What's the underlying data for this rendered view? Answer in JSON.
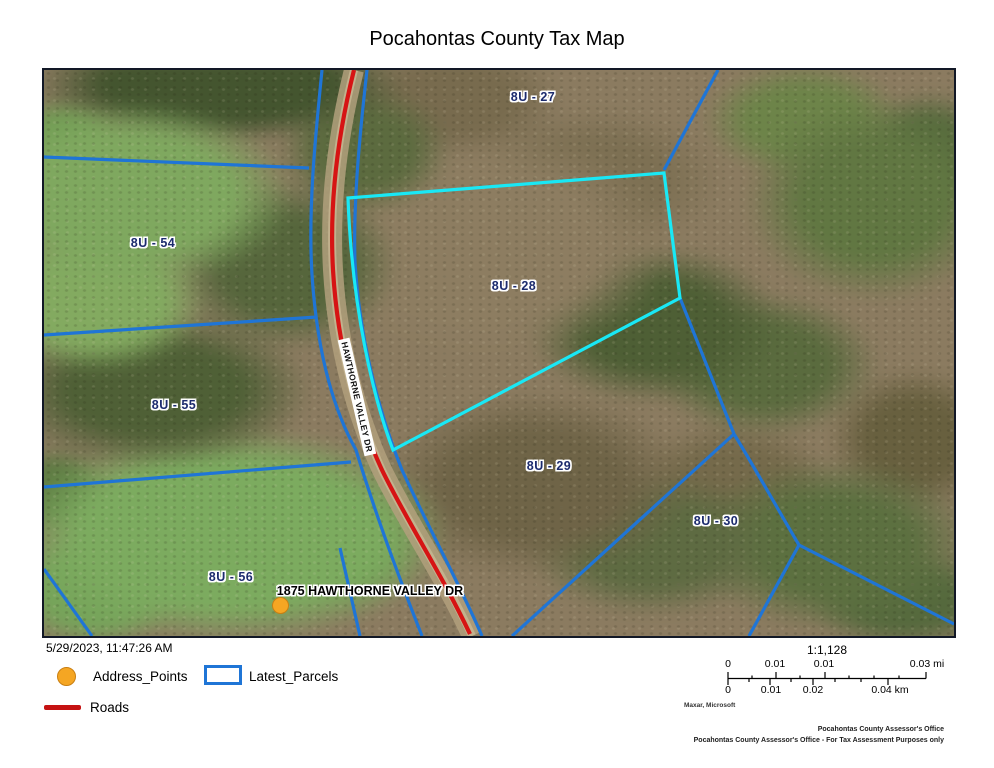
{
  "title": "Pocahontas County Tax Map",
  "map": {
    "parcel_labels": [
      "8U - 27",
      "8U - 54",
      "8U - 28",
      "8U - 55",
      "8U - 29",
      "8U - 30",
      "8U - 56"
    ],
    "highlighted_parcel": "8U - 28",
    "road_label": "HAWTHORNE VALLEY DR",
    "address_point_label": "1875 HAWTHORNE VALLEY DR",
    "colors": {
      "parcel_line": "#1f75d6",
      "highlighted_parcel_line": "#19e8f5",
      "road_line": "#d61414",
      "address_point": "#f5a623",
      "parcel_label_text": "#1c2b6e"
    }
  },
  "legend": {
    "timestamp": "5/29/2023, 11:47:26 AM",
    "items": [
      "Address_Points",
      "Latest_Parcels",
      "Roads"
    ]
  },
  "scale": {
    "ratio": "1:1,128",
    "mi_labels": [
      "0",
      "0.01",
      "0.01",
      "0.03 mi"
    ],
    "km_labels": [
      "0",
      "0.01",
      "0.02",
      "0.04 km"
    ],
    "attribution": "Maxar, Microsoft"
  },
  "footer": {
    "line1": "Pocahontas County Assessor's Office",
    "line2": "Pocahontas County Assessor's Office - For Tax Assessment Purposes only"
  }
}
